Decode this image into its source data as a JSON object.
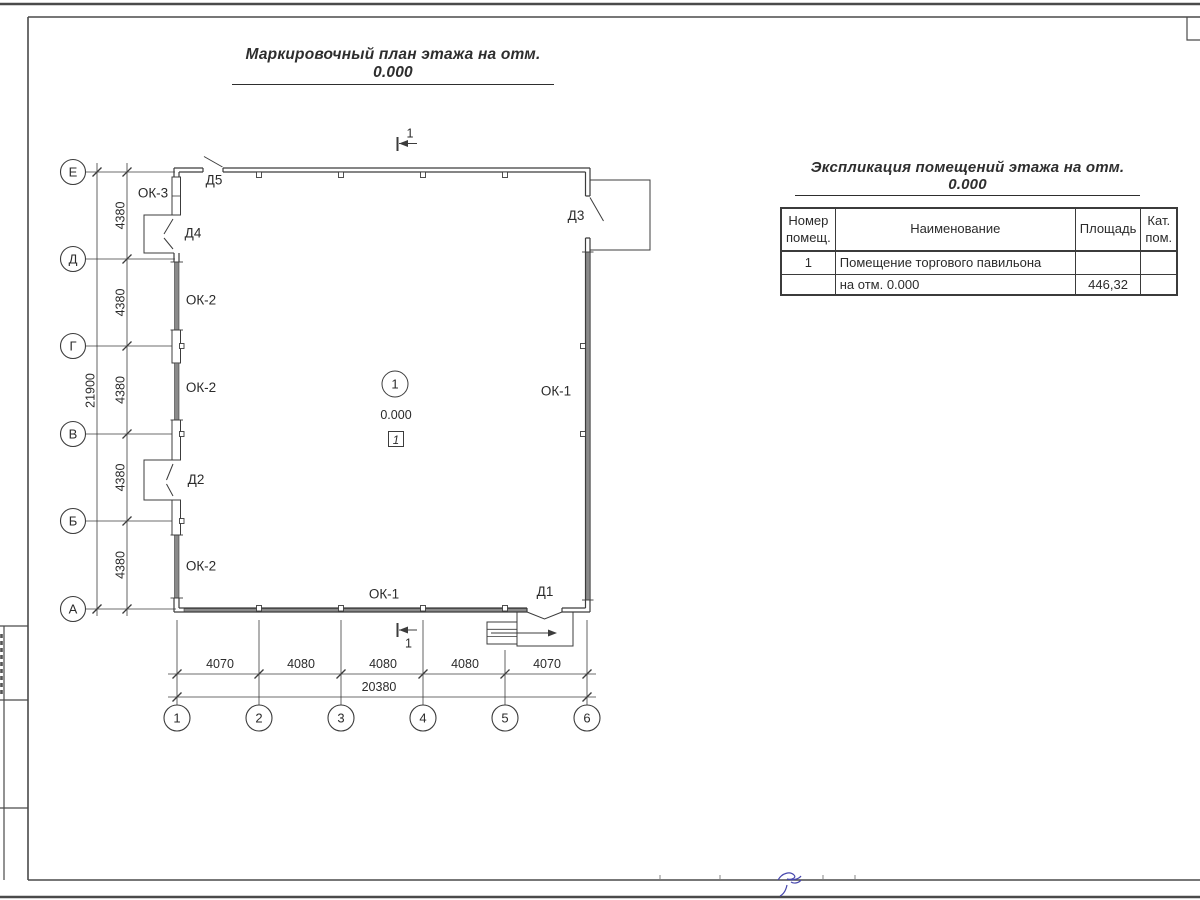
{
  "titles": {
    "main": "Маркировочный план этажа на отм. 0.000",
    "schedule": "Экспликация помещений этажа на отм. 0.000"
  },
  "schedule_table": {
    "col_num_line1": "Номер",
    "col_num_line2": "помещ.",
    "col_name": "Наименование",
    "col_area": "Площадь",
    "col_cat_line1": "Кат.",
    "col_cat_line2": "пом.",
    "rows": [
      {
        "num": "1",
        "name": "Помещение торгового павильона",
        "area": "",
        "cat": ""
      },
      {
        "num": "",
        "name": "на отм. 0.000",
        "area": "446,32",
        "cat": ""
      }
    ]
  },
  "plan": {
    "axis_letters": [
      "Е",
      "Д",
      "Г",
      "В",
      "Б",
      "А"
    ],
    "grid_numbers": [
      "1",
      "2",
      "3",
      "4",
      "5",
      "6"
    ],
    "dim_vertical_total": "21900",
    "dim_vertical_segments": [
      "4380",
      "4380",
      "4380",
      "4380",
      "4380"
    ],
    "dim_horizontal_segments": [
      "4070",
      "4080",
      "4080",
      "4080",
      "4070"
    ],
    "dim_horizontal_total": "20380",
    "section_label": "1",
    "room_number": "1",
    "elevation": "0.000",
    "floor_number": "1",
    "windows": {
      "ok1_right": "ОК-1",
      "ok1_bottom": "ОК-1",
      "ok2_upper": "ОК-2",
      "ok2_middle": "ОК-2",
      "ok2_lower": "ОК-2",
      "ok3": "ОК-3"
    },
    "doors": {
      "d1": "Д1",
      "d2": "Д2",
      "d3": "Д3",
      "d4": "Д4",
      "d5": "Д5"
    }
  },
  "colors": {
    "line": "#3c3c3c",
    "window_fill": "#8a8a8a",
    "signature": "#4747ad"
  }
}
